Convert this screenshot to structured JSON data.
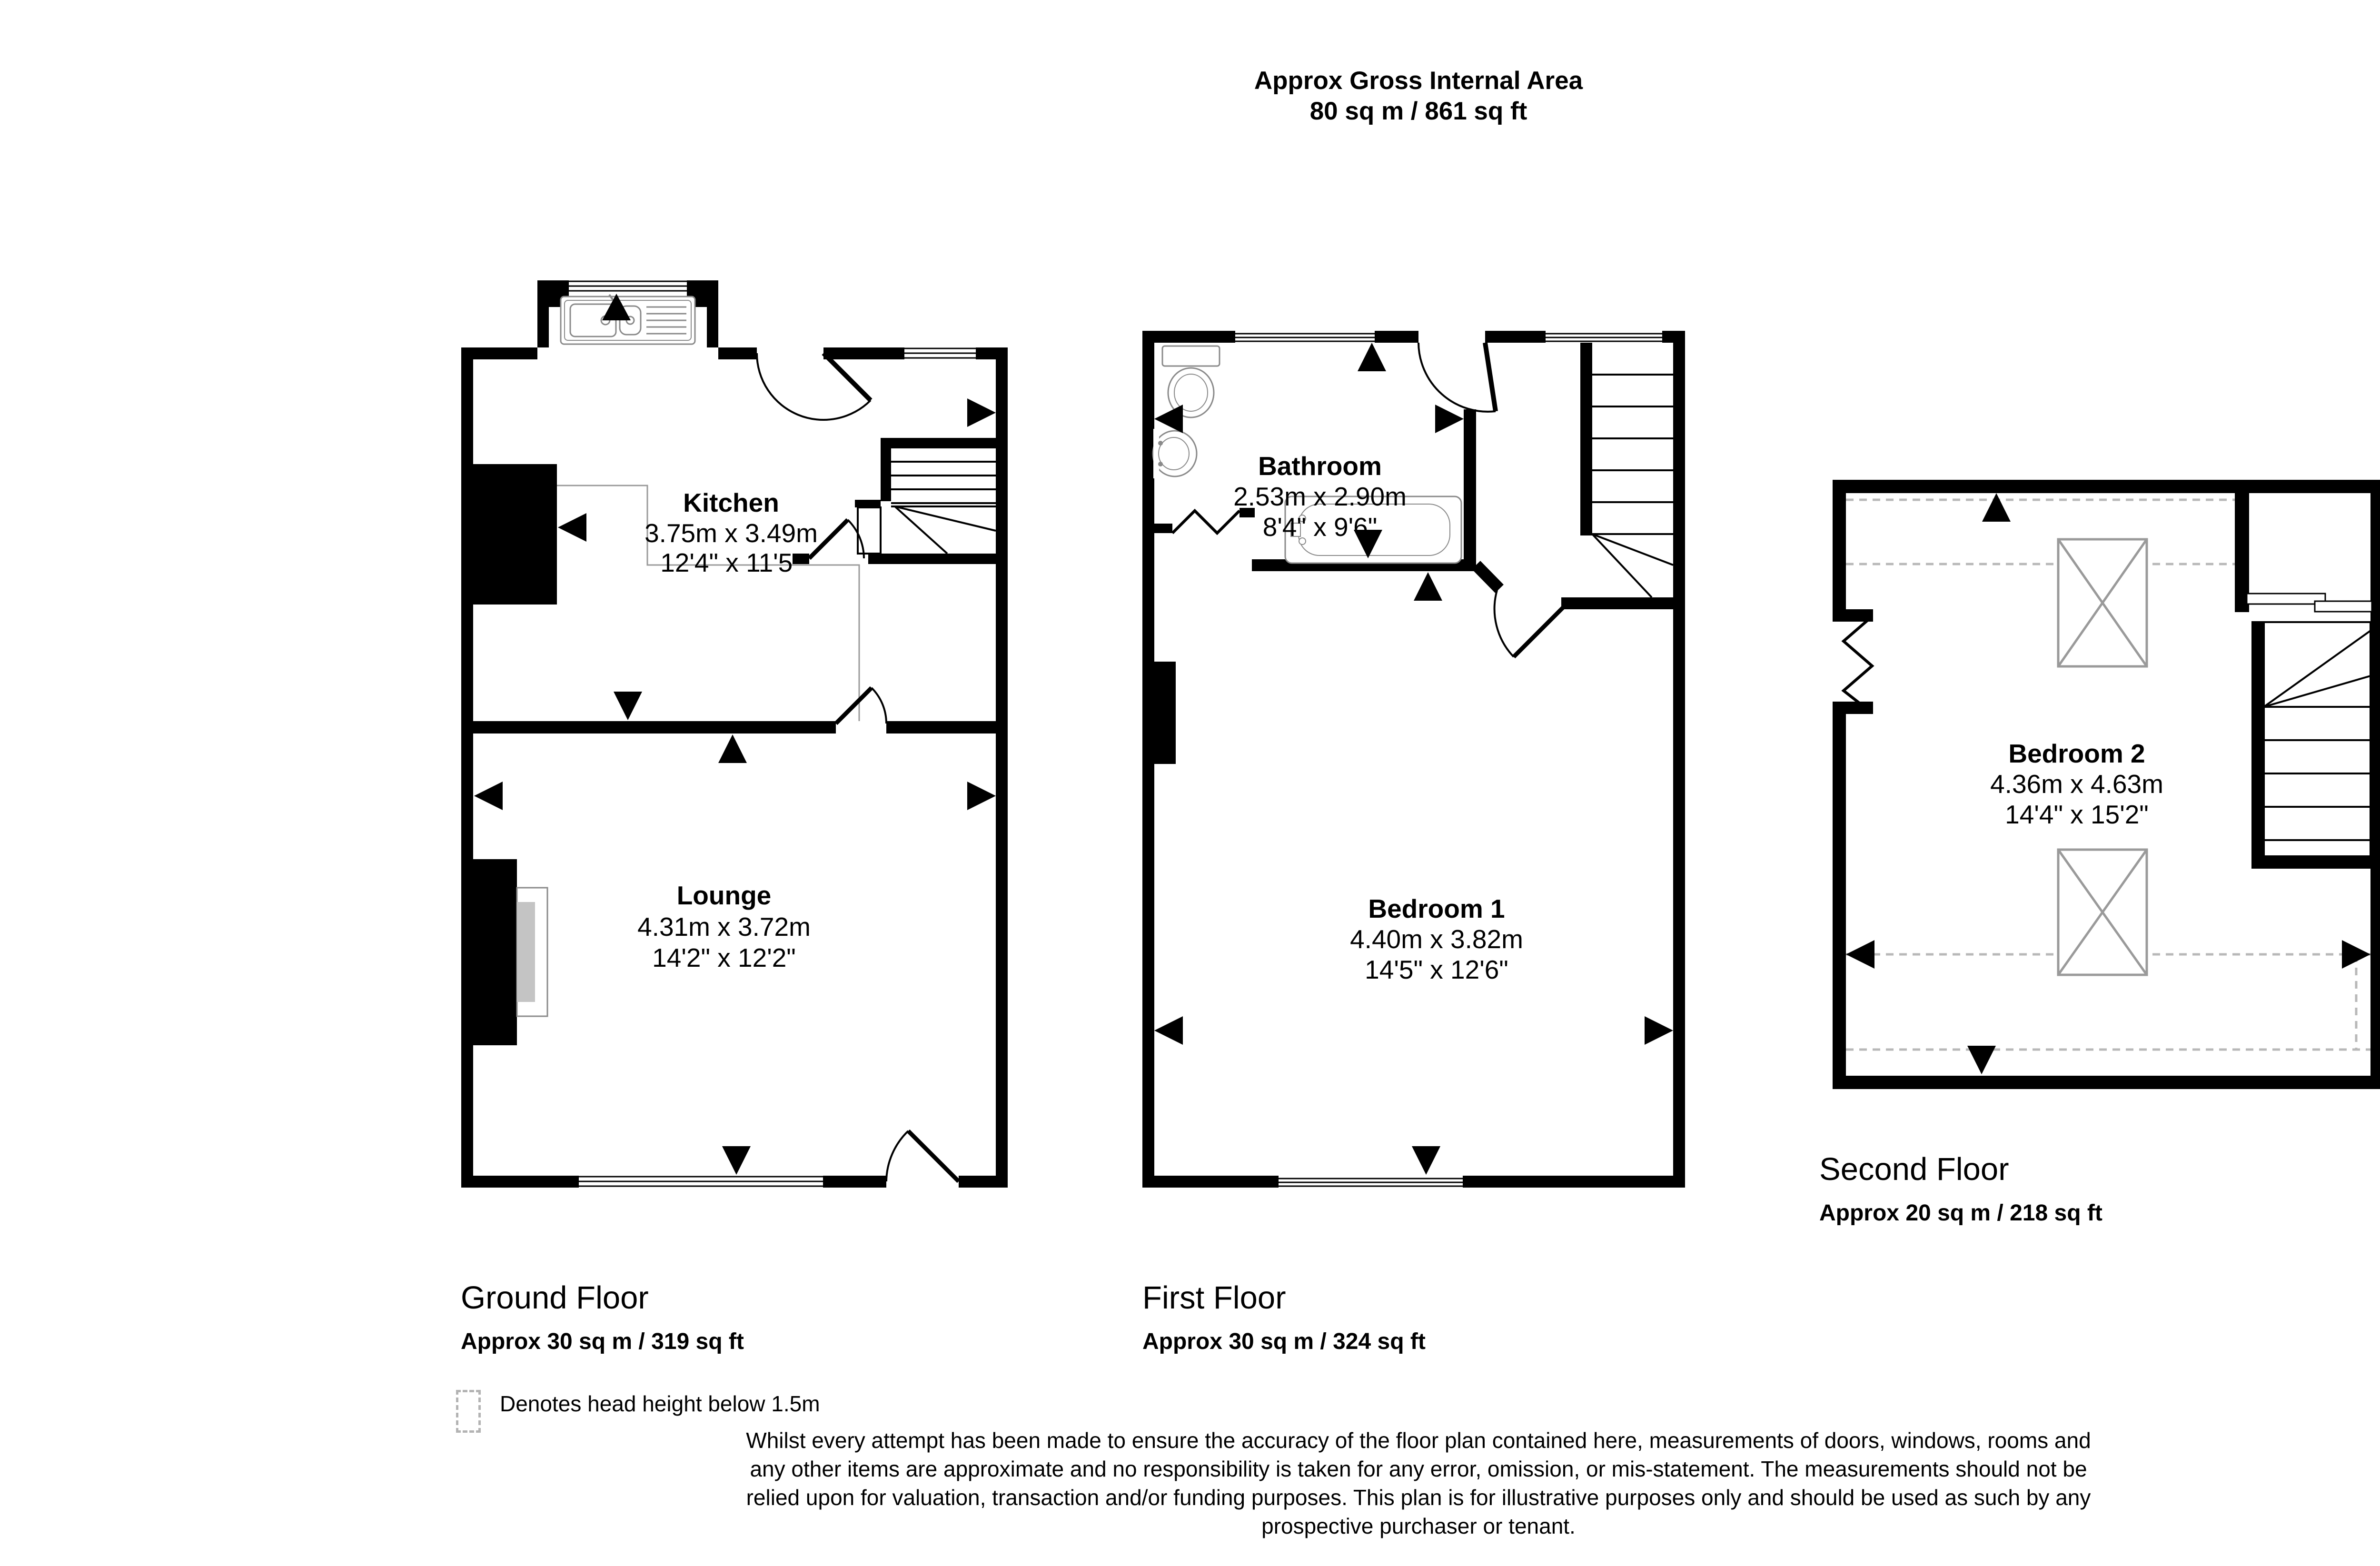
{
  "header": {
    "title_line1": "Approx Gross Internal Area",
    "title_line2": "80 sq m / 861 sq ft"
  },
  "compass": {
    "n": "N",
    "e": "E",
    "s": "S",
    "w": "W",
    "color": "#3d3d3d"
  },
  "floors": [
    {
      "name": "Ground Floor",
      "area": "Approx 30 sq m / 319 sq ft",
      "rooms": [
        {
          "name": "Kitchen",
          "dim_metric": "3.75m x 3.49m",
          "dim_imperial": "12'4\" x 11'5\""
        },
        {
          "name": "Lounge",
          "dim_metric": "4.31m x 3.72m",
          "dim_imperial": "14'2\" x 12'2\""
        }
      ]
    },
    {
      "name": "First Floor",
      "area": "Approx 30 sq m / 324 sq ft",
      "rooms": [
        {
          "name": "Bathroom",
          "dim_metric": "2.53m x 2.90m",
          "dim_imperial": "8'4\" x 9'6\""
        },
        {
          "name": "Bedroom 1",
          "dim_metric": "4.40m x 3.82m",
          "dim_imperial": "14'5\" x 12'6\""
        }
      ]
    },
    {
      "name": "Second Floor",
      "area": "Approx 20 sq m / 218 sq ft",
      "rooms": [
        {
          "name": "Bedroom 2",
          "dim_metric": "4.36m x 4.63m",
          "dim_imperial": "14'4\" x 15'2\""
        }
      ]
    }
  ],
  "legend": {
    "label": "Denotes head height below 1.5m"
  },
  "disclaimer": {
    "lines": [
      "Whilst every attempt has been made to ensure the accuracy of the floor plan contained here, measurements of doors, windows, rooms and",
      "any other items are approximate and no responsibility is taken for any error, omission, or mis-statement. The measurements should not be",
      "relied upon for valuation, transaction and/or funding purposes. This plan is for illustrative purposes only and should be used as such by any",
      "prospective purchaser or tenant."
    ]
  },
  "colors": {
    "wall": "#000000",
    "fixture": "#8a8a8a",
    "head_height_dash": "#b8b8b8",
    "compass": "#3d3d3d",
    "text": "#000000"
  }
}
